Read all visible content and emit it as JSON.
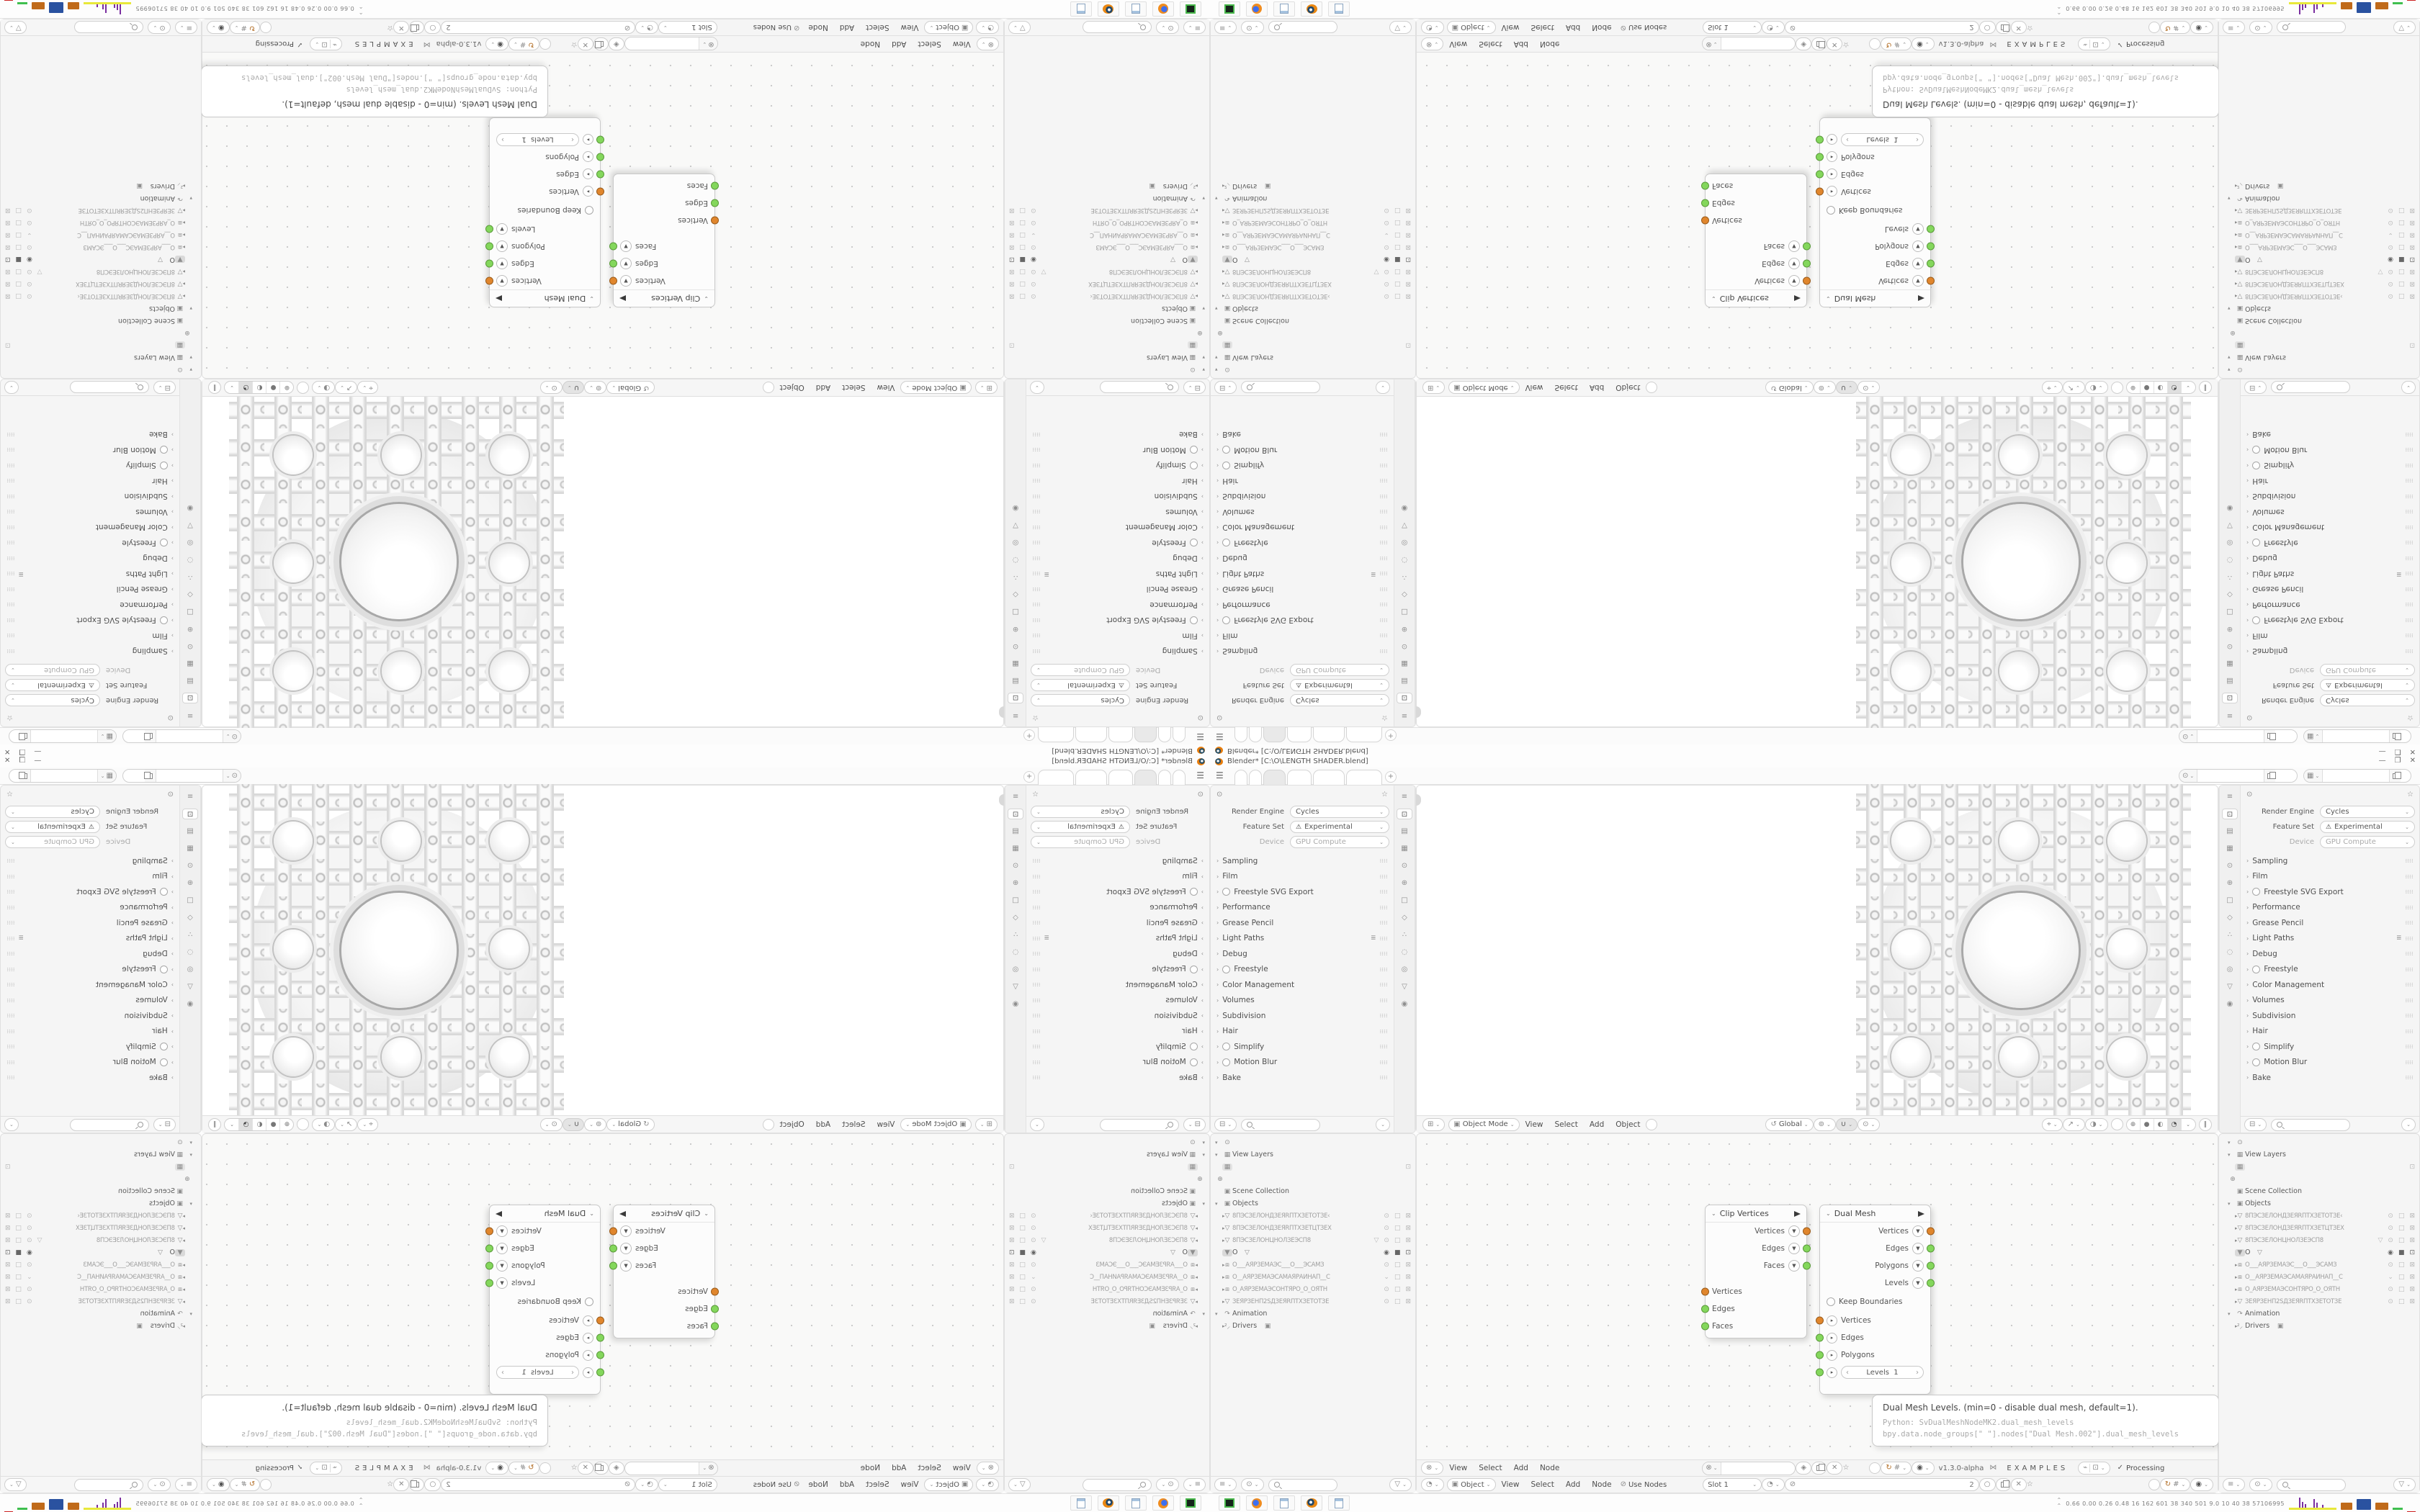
{
  "window": {
    "title": "Blender* [C:\\O\\LENGTH SHADER.blend]",
    "minimize": "—",
    "maximize": "❐",
    "close": "✕"
  },
  "topbar": {
    "menu_icon": "☰",
    "add_tab": "+",
    "active_tab_index": 2
  },
  "properties": {
    "render_engine_label": "Render Engine",
    "render_engine_value": "Cycles",
    "feature_set_label": "Feature Set",
    "feature_set_value": "Experimental",
    "device_label": "Device",
    "device_value": "GPU Compute",
    "sections": [
      {
        "label": "Sampling"
      },
      {
        "label": "Film"
      },
      {
        "label": "Freestyle SVG Export"
      },
      {
        "label": "Performance"
      },
      {
        "label": "Grease Pencil"
      },
      {
        "label": "Light Paths"
      },
      {
        "label": "Debug"
      },
      {
        "label": "Freestyle"
      },
      {
        "label": "Color Management"
      },
      {
        "label": "Volumes"
      },
      {
        "label": "Subdivision"
      },
      {
        "label": "Hair"
      },
      {
        "label": "Simplify"
      },
      {
        "label": "Motion Blur"
      },
      {
        "label": "Bake"
      }
    ]
  },
  "viewport": {
    "mode": "Object Mode",
    "menus": [
      "View",
      "Select",
      "Add",
      "Object"
    ],
    "orientation": "Global",
    "pause": "∥"
  },
  "node_editor": {
    "menus": [
      "View",
      "Select",
      "Add",
      "Node"
    ],
    "version": "v1.3.0-alpha",
    "examples": "EXAMPLES",
    "processing": "Processing",
    "clip_node": {
      "title": "Clip Vertices",
      "out_rows": [
        "Vertices",
        "Edges",
        "Faces"
      ],
      "in_rows": [
        "Vertices",
        "Edges",
        "Faces"
      ]
    },
    "dual_node": {
      "title": "Dual Mesh",
      "out_rows": [
        "Vertices",
        "Edges",
        "Polygons",
        "Levels"
      ],
      "keep_boundaries": "Keep Boundaries",
      "in_rows": [
        "Vertices",
        "Edges",
        "Polygons"
      ],
      "levels_label": "Levels",
      "levels_value": "1"
    },
    "tooltip": {
      "line1": "Dual Mesh Levels. (min=0 - disable dual mesh, default=1).",
      "line2": "Python: SvDualMeshNodeMK2.dual_mesh_levels",
      "line3": "bpy.data.node_groups[\" \"].nodes[\"Dual Mesh.002\"].dual_mesh_levels"
    }
  },
  "shader_header": {
    "object": "Object",
    "menus": [
      "View",
      "Select",
      "Add",
      "Node"
    ],
    "use_nodes": "Use Nodes",
    "slot": "Slot 1",
    "mat_count": "2"
  },
  "outliner": {
    "view_layers": "View Layers",
    "scene_collection": "Scene Collection",
    "objects_label": "Objects",
    "objects": [
      "8ПЭСЗЕЛОНДЗЕЯRПТХЗЕТОТЗЕ‹",
      "8ПЭСЗЕЛОНДЗЕЯRПТХЗЕТЦТЗЕХ",
      "8ПЭСЗЕЛОНЦНОЛЗЕЭСП8",
      "O",
      "O___АЯРЗЕМАЭС___O___ЭСАМЗ",
      "O__АЯРЗЕМАЭСАМАЯРАИНАП__С",
      "O_АЯРЗЕМАЭСОНТЯРО_O_ОЯТН",
      "ЗЕЯРЗЕНП2SДЗЕЯRПТХЗЕТОТЗЕ"
    ],
    "animation": "Animation",
    "drivers": "Drivers"
  },
  "taskbar": {
    "tray_values": "0.66 0.00 0.26 0.48   16   162   601   38   340   501   9.0   10   40   38   57106995"
  }
}
